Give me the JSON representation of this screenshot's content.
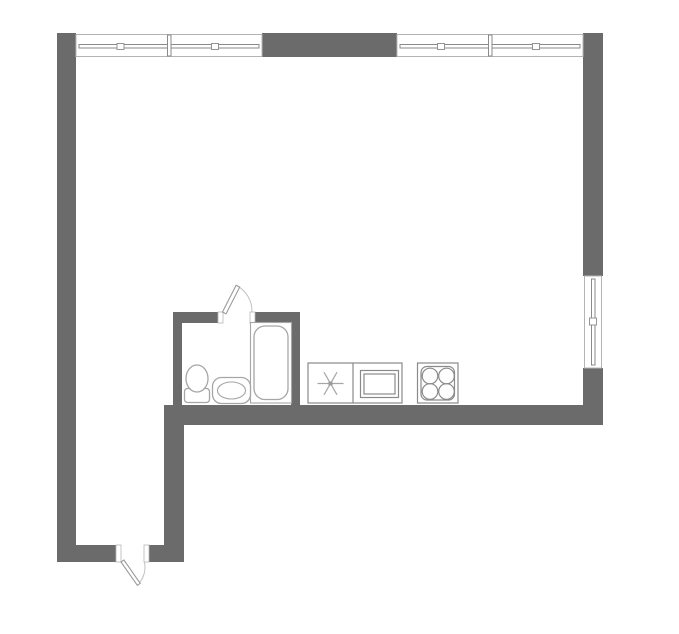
{
  "colors": {
    "background": "#ffffff",
    "wall": "#6b6b6b",
    "window-frame": "#b4b4b4",
    "window-glass": "#8a8a8a",
    "fixture": "#a6a6a6",
    "counter": "#8a8a8a",
    "door": "#9a9a9a",
    "door-arc": "#c0c0c0"
  },
  "plan": {
    "type": "apartment-floor-plan",
    "rooms": [
      {
        "name": "main-room",
        "fixtures": [
          "kitchen-sink",
          "oven",
          "cooktop"
        ]
      },
      {
        "name": "bathroom",
        "fixtures": [
          "toilet",
          "washbasin",
          "bathtub"
        ]
      },
      {
        "name": "entry-hall",
        "fixtures": []
      }
    ],
    "openings": {
      "windows": [
        "top-window-left-pane-1",
        "top-window-left-pane-2",
        "top-window-right-pane-1",
        "top-window-right-pane-2",
        "right-wall-window"
      ],
      "doors": [
        "bathroom-door",
        "entrance-door"
      ]
    }
  }
}
